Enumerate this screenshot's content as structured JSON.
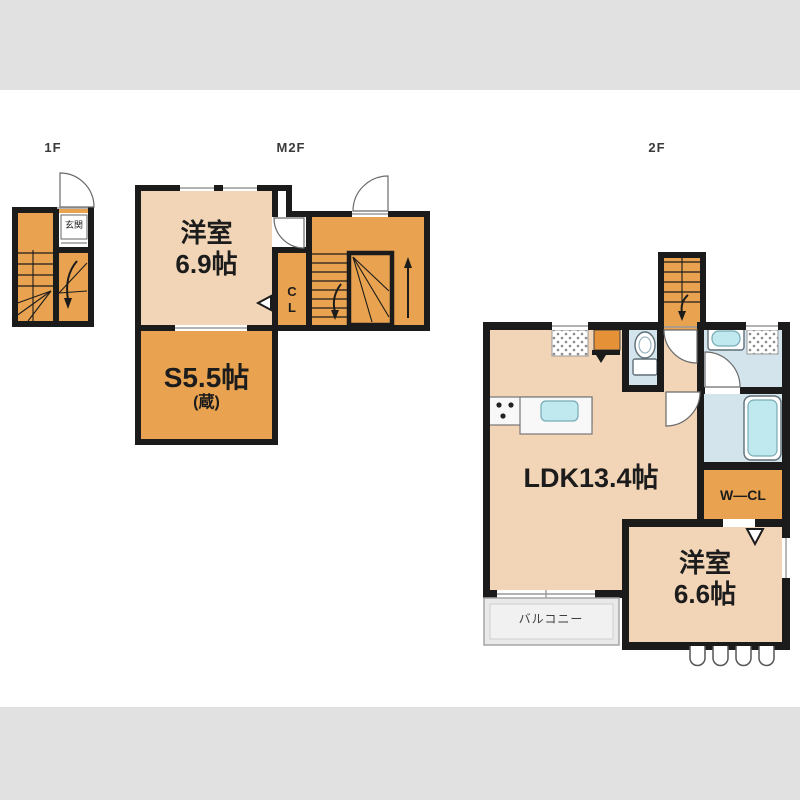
{
  "image_type": "real-estate floor plan (madori-zu), letterboxed",
  "colors": {
    "room_light": "#f2d4b6",
    "room_orange": "#e9a350",
    "accent_orange": "#e49138",
    "wall": "#1b1b1b",
    "wet_room": "#d3e4ec",
    "fixture_blue": "#bfe9ef",
    "balcony_gray": "#e9e9e9",
    "frame_gray": "#e1e1e1"
  },
  "floors": {
    "f1": {
      "label": "1F",
      "genkan": "玄関"
    },
    "m2f": {
      "label": "M2F",
      "room1_name": "洋室",
      "room1_size": "6.9帖",
      "storage_name": "S5.5帖",
      "storage_sub": "(蔵)",
      "closet_c": "C",
      "closet_l": "L"
    },
    "f2": {
      "label": "2F",
      "ldk": "LDK13.4帖",
      "wcl": "W—CL",
      "room_name": "洋室",
      "room_size": "6.6帖",
      "balcony": "バルコニー"
    }
  }
}
